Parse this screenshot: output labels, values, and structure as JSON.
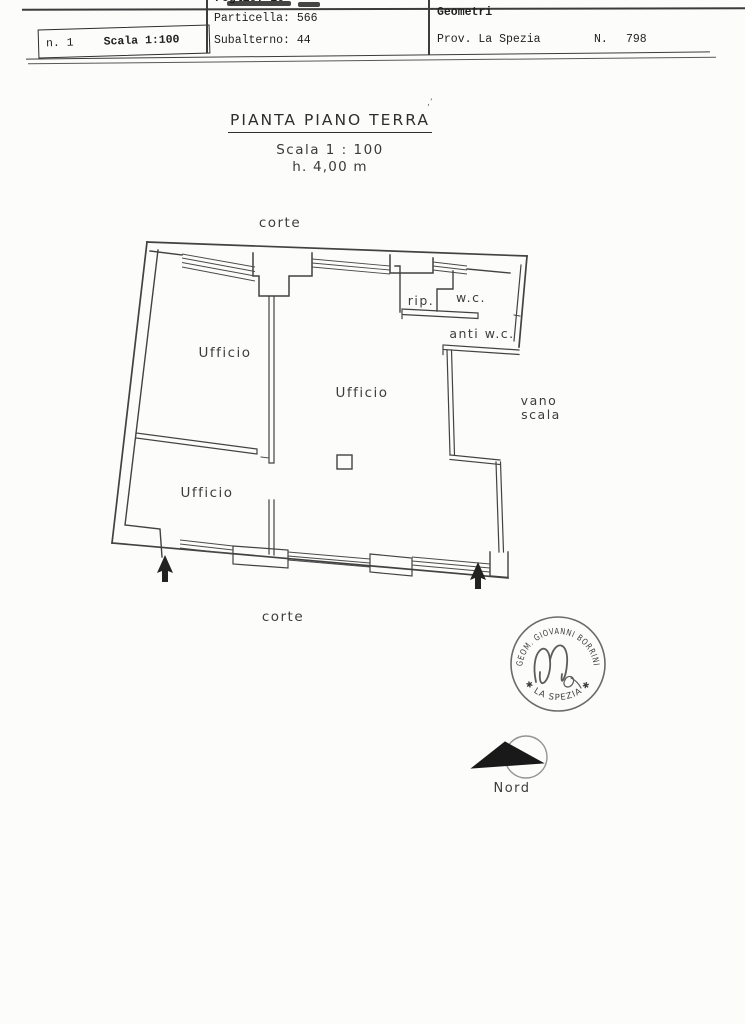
{
  "header": {
    "box": {
      "number": "n. 1",
      "scale": "Scala 1:100"
    },
    "cadastral": {
      "foglio": "Foglio: 16",
      "particella": "Particella: 566",
      "subalterno": "Subalterno: 44"
    },
    "registry": {
      "albo": "Iscritto all'Albo:",
      "geometri": "Geometri",
      "province": "Prov. La Spezia",
      "n_label": "N.",
      "number": "798"
    }
  },
  "title_block": {
    "title": "PIANTA PIANO TERRA",
    "scale": "Scala 1 : 100",
    "height": "h. 4,00 m"
  },
  "plan": {
    "labels": {
      "corte_top": "corte",
      "corte_bottom": "corte",
      "ufficio_left": "Ufficio",
      "ufficio_center": "Ufficio",
      "ufficio_bottom": "Ufficio",
      "rip": "rip.",
      "wc": "w.c.",
      "anti_wc": "anti w.c.",
      "vano_line1": "vano",
      "vano_line2": "scala"
    }
  },
  "stamp": {
    "arc_top": "GEOM. GIOVANNI BORRINI",
    "arc_bottom": "✱  LA SPEZIA  ✱"
  },
  "north": {
    "label": "Nord"
  },
  "colors": {
    "ink": "#3d3d3d",
    "stamp": "#6b6b6b",
    "north_fill": "#191919"
  }
}
